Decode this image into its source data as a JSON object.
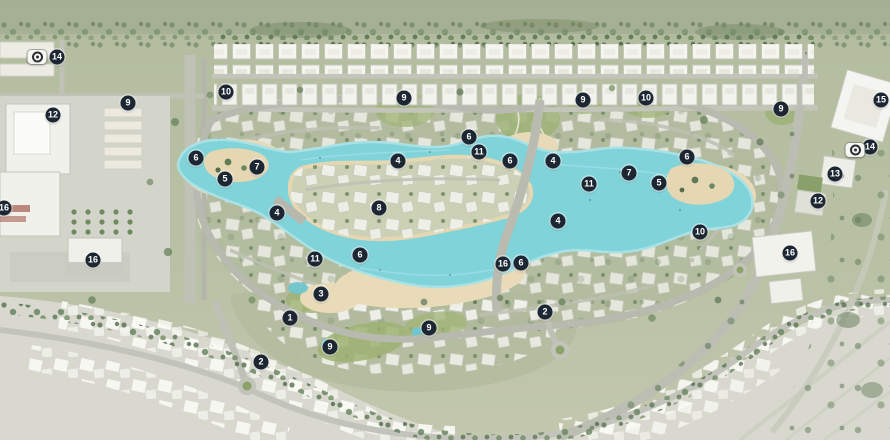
{
  "map": {
    "colors": {
      "marker_bg": "#1d2733",
      "marker_text": "#ffffff",
      "lagoon": "#7fd3d9",
      "sand": "#e8dab8",
      "site_green": "#b7c0a4",
      "faded_district": "#d8d8ce",
      "road": "#b9bbb0",
      "house": "#f4f4ef"
    },
    "markers": [
      {
        "label": "14",
        "x": 57,
        "y": 57
      },
      {
        "label": "10",
        "x": 226,
        "y": 92
      },
      {
        "label": "9",
        "x": 404,
        "y": 98
      },
      {
        "label": "10",
        "x": 646,
        "y": 98
      },
      {
        "label": "9",
        "x": 583,
        "y": 100
      },
      {
        "label": "15",
        "x": 881,
        "y": 100
      },
      {
        "label": "9",
        "x": 128,
        "y": 103
      },
      {
        "label": "9",
        "x": 781,
        "y": 109
      },
      {
        "label": "12",
        "x": 53,
        "y": 115
      },
      {
        "label": "6",
        "x": 469,
        "y": 137
      },
      {
        "label": "14",
        "x": 870,
        "y": 147
      },
      {
        "label": "11",
        "x": 479,
        "y": 152
      },
      {
        "label": "6",
        "x": 196,
        "y": 158
      },
      {
        "label": "6",
        "x": 510,
        "y": 161
      },
      {
        "label": "4",
        "x": 398,
        "y": 161
      },
      {
        "label": "4",
        "x": 553,
        "y": 161
      },
      {
        "label": "6",
        "x": 687,
        "y": 157
      },
      {
        "label": "7",
        "x": 257,
        "y": 167
      },
      {
        "label": "7",
        "x": 629,
        "y": 173
      },
      {
        "label": "13",
        "x": 835,
        "y": 174
      },
      {
        "label": "5",
        "x": 225,
        "y": 179
      },
      {
        "label": "5",
        "x": 659,
        "y": 183
      },
      {
        "label": "11",
        "x": 589,
        "y": 184
      },
      {
        "label": "12",
        "x": 818,
        "y": 201
      },
      {
        "label": "8",
        "x": 379,
        "y": 208
      },
      {
        "label": "16",
        "x": 4,
        "y": 208
      },
      {
        "label": "4",
        "x": 277,
        "y": 213
      },
      {
        "label": "4",
        "x": 558,
        "y": 221
      },
      {
        "label": "10",
        "x": 700,
        "y": 232
      },
      {
        "label": "16",
        "x": 790,
        "y": 253
      },
      {
        "label": "6",
        "x": 360,
        "y": 255
      },
      {
        "label": "11",
        "x": 315,
        "y": 259
      },
      {
        "label": "16",
        "x": 93,
        "y": 260
      },
      {
        "label": "16",
        "x": 503,
        "y": 264
      },
      {
        "label": "6",
        "x": 521,
        "y": 263
      },
      {
        "label": "3",
        "x": 321,
        "y": 294
      },
      {
        "label": "2",
        "x": 545,
        "y": 312
      },
      {
        "label": "1",
        "x": 290,
        "y": 318
      },
      {
        "label": "9",
        "x": 429,
        "y": 328
      },
      {
        "label": "9",
        "x": 330,
        "y": 347
      },
      {
        "label": "2",
        "x": 261,
        "y": 362
      }
    ],
    "camera_icons": [
      {
        "x": 37,
        "y": 57
      },
      {
        "x": 855,
        "y": 150
      }
    ]
  }
}
